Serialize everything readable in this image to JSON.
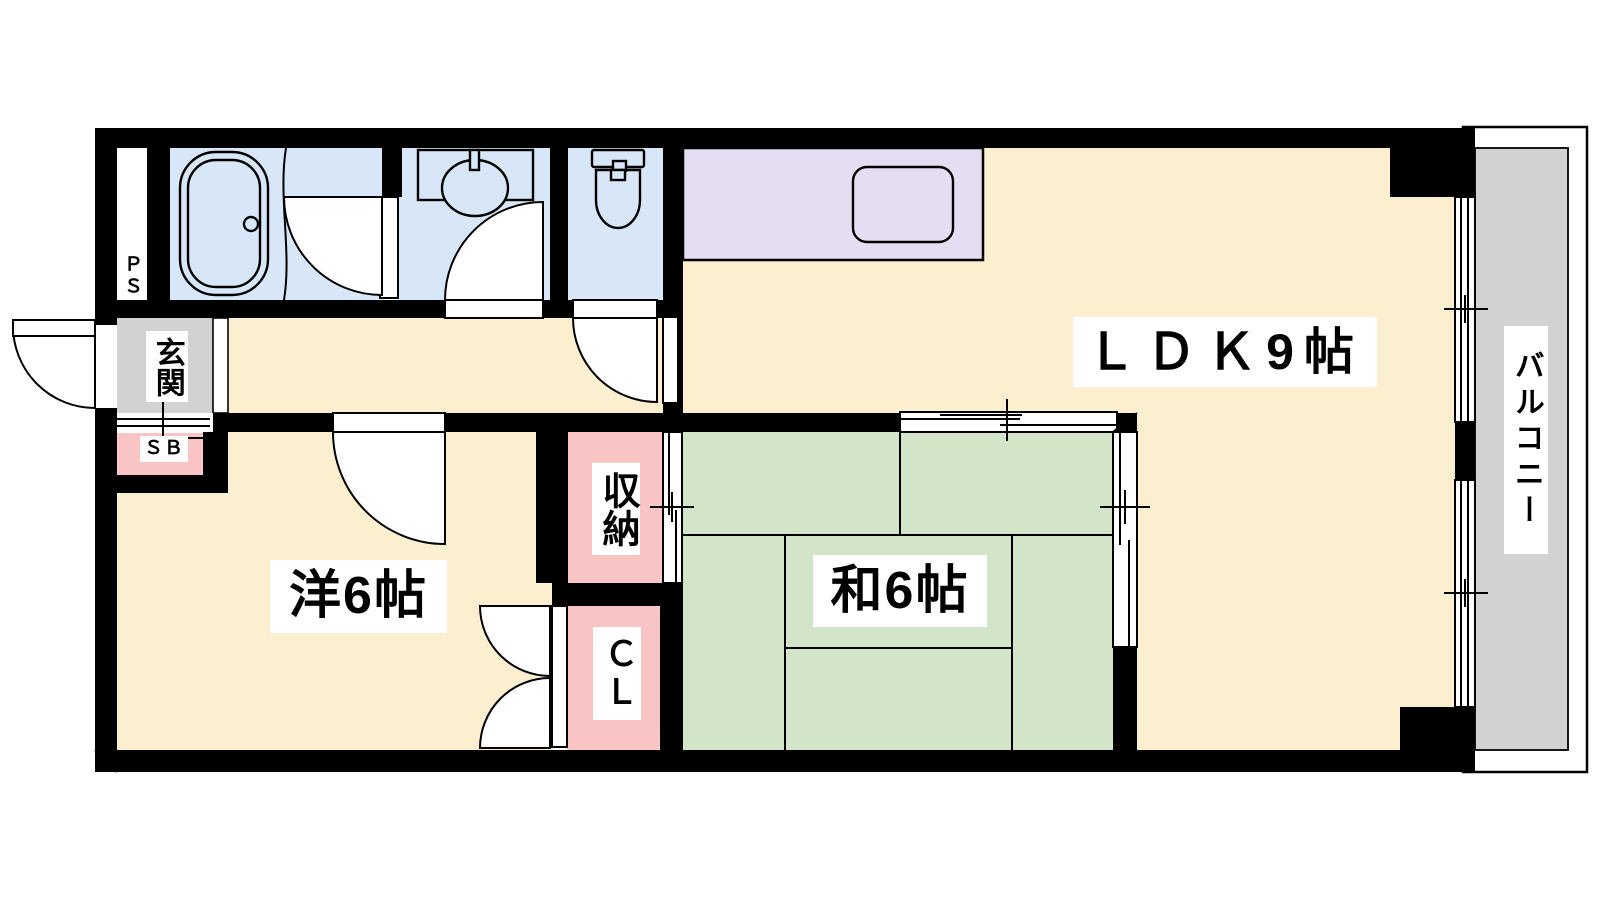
{
  "title": "apartment-floor-plan",
  "rooms": {
    "ldk": {
      "label": "ＬＤＫ9帖"
    },
    "japanese": {
      "label": "和6帖"
    },
    "western": {
      "label": "洋6帖"
    },
    "storage": {
      "label": "収納"
    },
    "closet": {
      "label": "ＣＬ"
    },
    "entrance": {
      "label": "玄関"
    },
    "shoe_box": {
      "label": "ＳＢ"
    },
    "pipe_space": {
      "label": "ＰＳ"
    },
    "balcony": {
      "label": "バルコニー"
    }
  },
  "colors": {
    "wall": "#000000",
    "floor_cream": "#FBEFD0",
    "tatami_green": "#D2E5C9",
    "wet_blue": "#D8E7F8",
    "kitchen_purple": "#E5DDF2",
    "storage_pink": "#F8C5C4",
    "entrance_gray": "#D2D2D2",
    "balcony_gray": "#D2D2D2",
    "opening_white": "#FFFFFF",
    "label_bg": "#FFFFFF",
    "line": "#000000"
  }
}
